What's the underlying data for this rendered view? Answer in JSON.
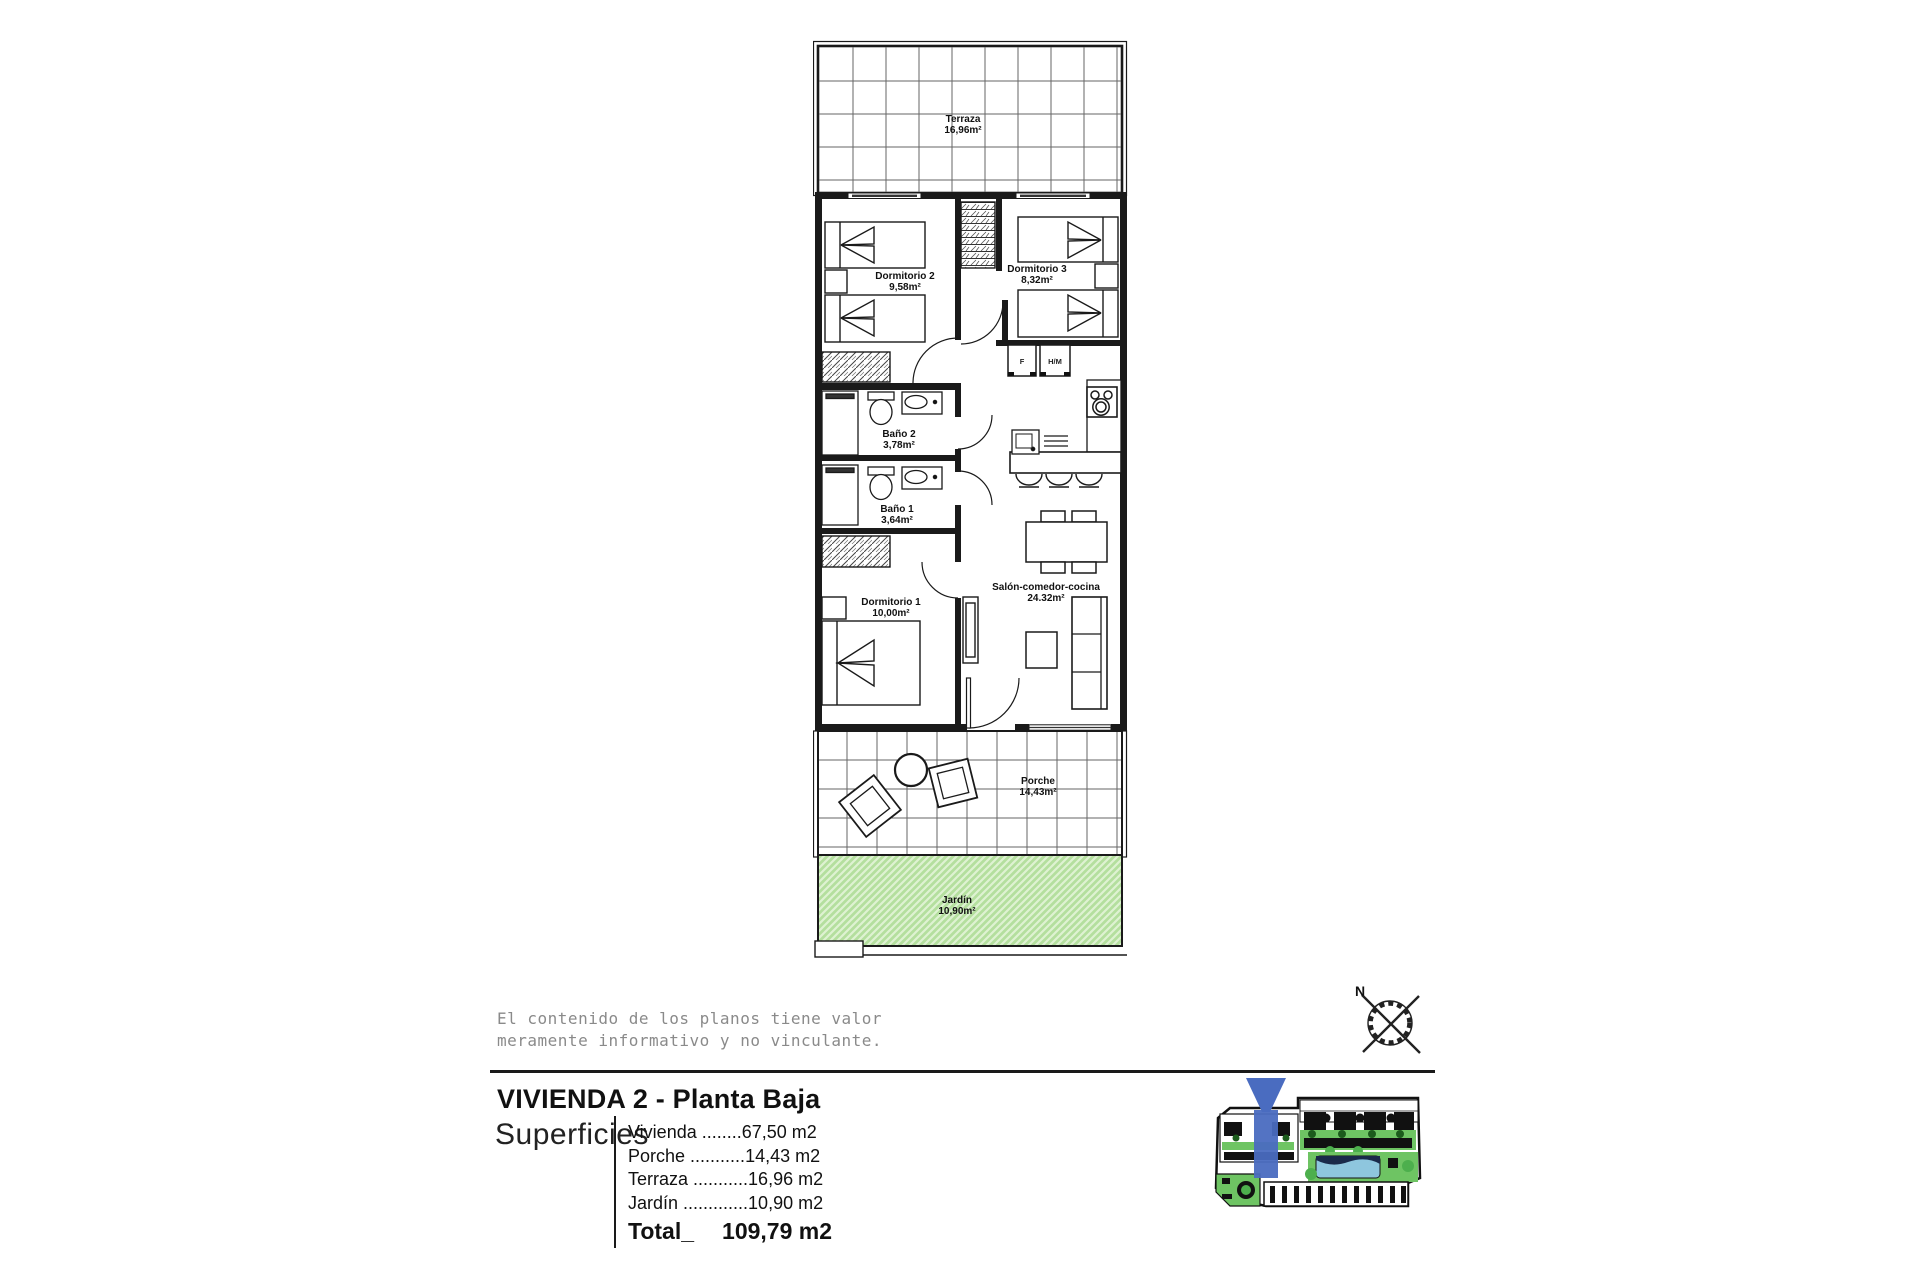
{
  "plan": {
    "terraza": {
      "name": "Terraza",
      "area": "16,96m²"
    },
    "dormitorio2": {
      "name": "Dormitorio 2",
      "area": "9,58m²"
    },
    "dormitorio3": {
      "name": "Dormitorio 3",
      "area": "8,32m²"
    },
    "bano2": {
      "name": "Baño 2",
      "area": "3,78m²"
    },
    "bano1": {
      "name": "Baño 1",
      "area": "3,64m²"
    },
    "dormitorio1": {
      "name": "Dormitorio 1",
      "area": "10,00m²"
    },
    "salon": {
      "name": "Salón-comedor-cocina",
      "area": "24.32m²"
    },
    "porche": {
      "name": "Porche",
      "area": "14,43m²"
    },
    "jardin": {
      "name": "Jardín",
      "area": "10,90m²"
    },
    "appliances": {
      "fridge": "F",
      "oven_micro": "H/M"
    }
  },
  "disclaimer": {
    "line1": "El contenido de los planos tiene valor",
    "line2": "meramente informativo y no vinculante."
  },
  "compass": {
    "north": "N"
  },
  "legend": {
    "title": "VIVIENDA 2 - Planta Baja",
    "superficies_label": "Superficies",
    "rows": [
      {
        "label": "Vivienda",
        "leader": " ........",
        "value": "67,50 m2"
      },
      {
        "label": "Porche",
        "leader": " ...........",
        "value": "14,43 m2"
      },
      {
        "label": "Terraza",
        "leader": " ...........",
        "value": "16,96 m2"
      },
      {
        "label": "Jardín",
        "leader": " .............",
        "value": "10,90 m2"
      }
    ],
    "total_label": "Total_",
    "total_value": "109,79 m2"
  },
  "colors": {
    "garden_fill": "#b4df9e",
    "garden_hatch": "#def2d2",
    "highlight_blue": "#4a6cc0",
    "site_green": "#6ec463",
    "pool_blue": "#8ec6de",
    "wall_black": "#1a1a1a"
  }
}
